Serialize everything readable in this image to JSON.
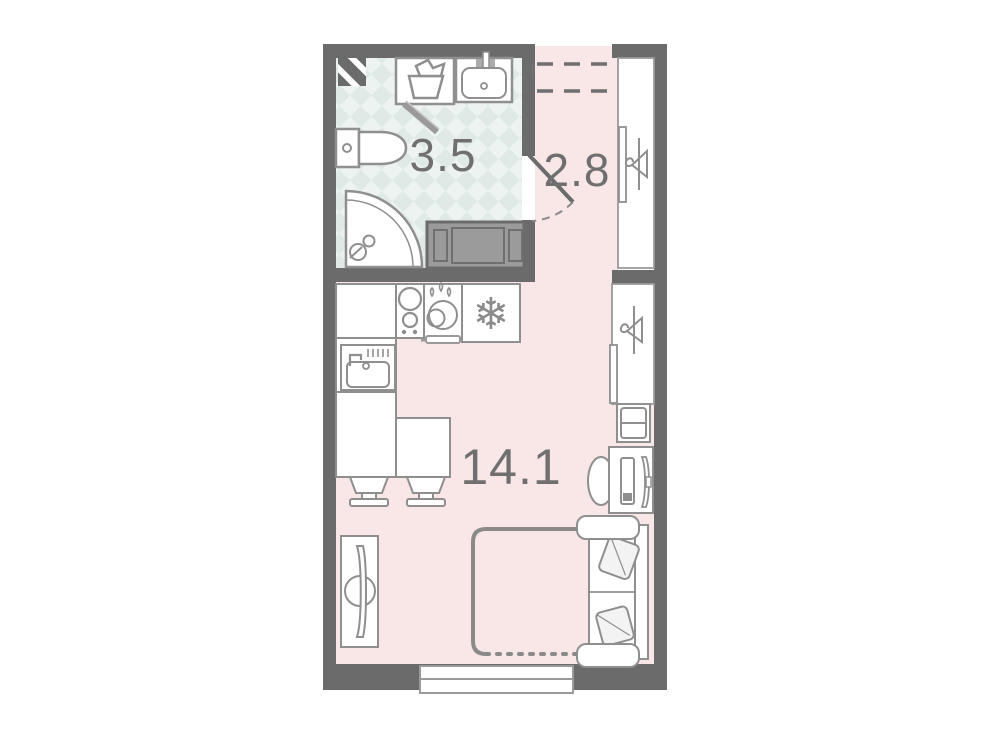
{
  "plan": {
    "type": "apartment-floor-plan",
    "rooms": {
      "bathroom": {
        "name": "bathroom",
        "area": "3.5"
      },
      "hallway": {
        "name": "hallway",
        "area": "2.8"
      },
      "living": {
        "name": "living-kitchen-room",
        "area": "14.1"
      }
    },
    "icons": {
      "fridge": "❄"
    },
    "colors": {
      "wall": "#6b6b6b",
      "line": "#8f8f8f",
      "line-dark": "#6f6f6f",
      "floor-pink": "#f8e7e6",
      "floor-teal": "#ecf3f0",
      "floor-teal-check": "#dfeae7",
      "furniture-fill": "#ffffff",
      "cabinet-fill": "#9b9b9b",
      "pillow-fill": "#f3f3f3",
      "label": "#6f6f6f"
    }
  }
}
